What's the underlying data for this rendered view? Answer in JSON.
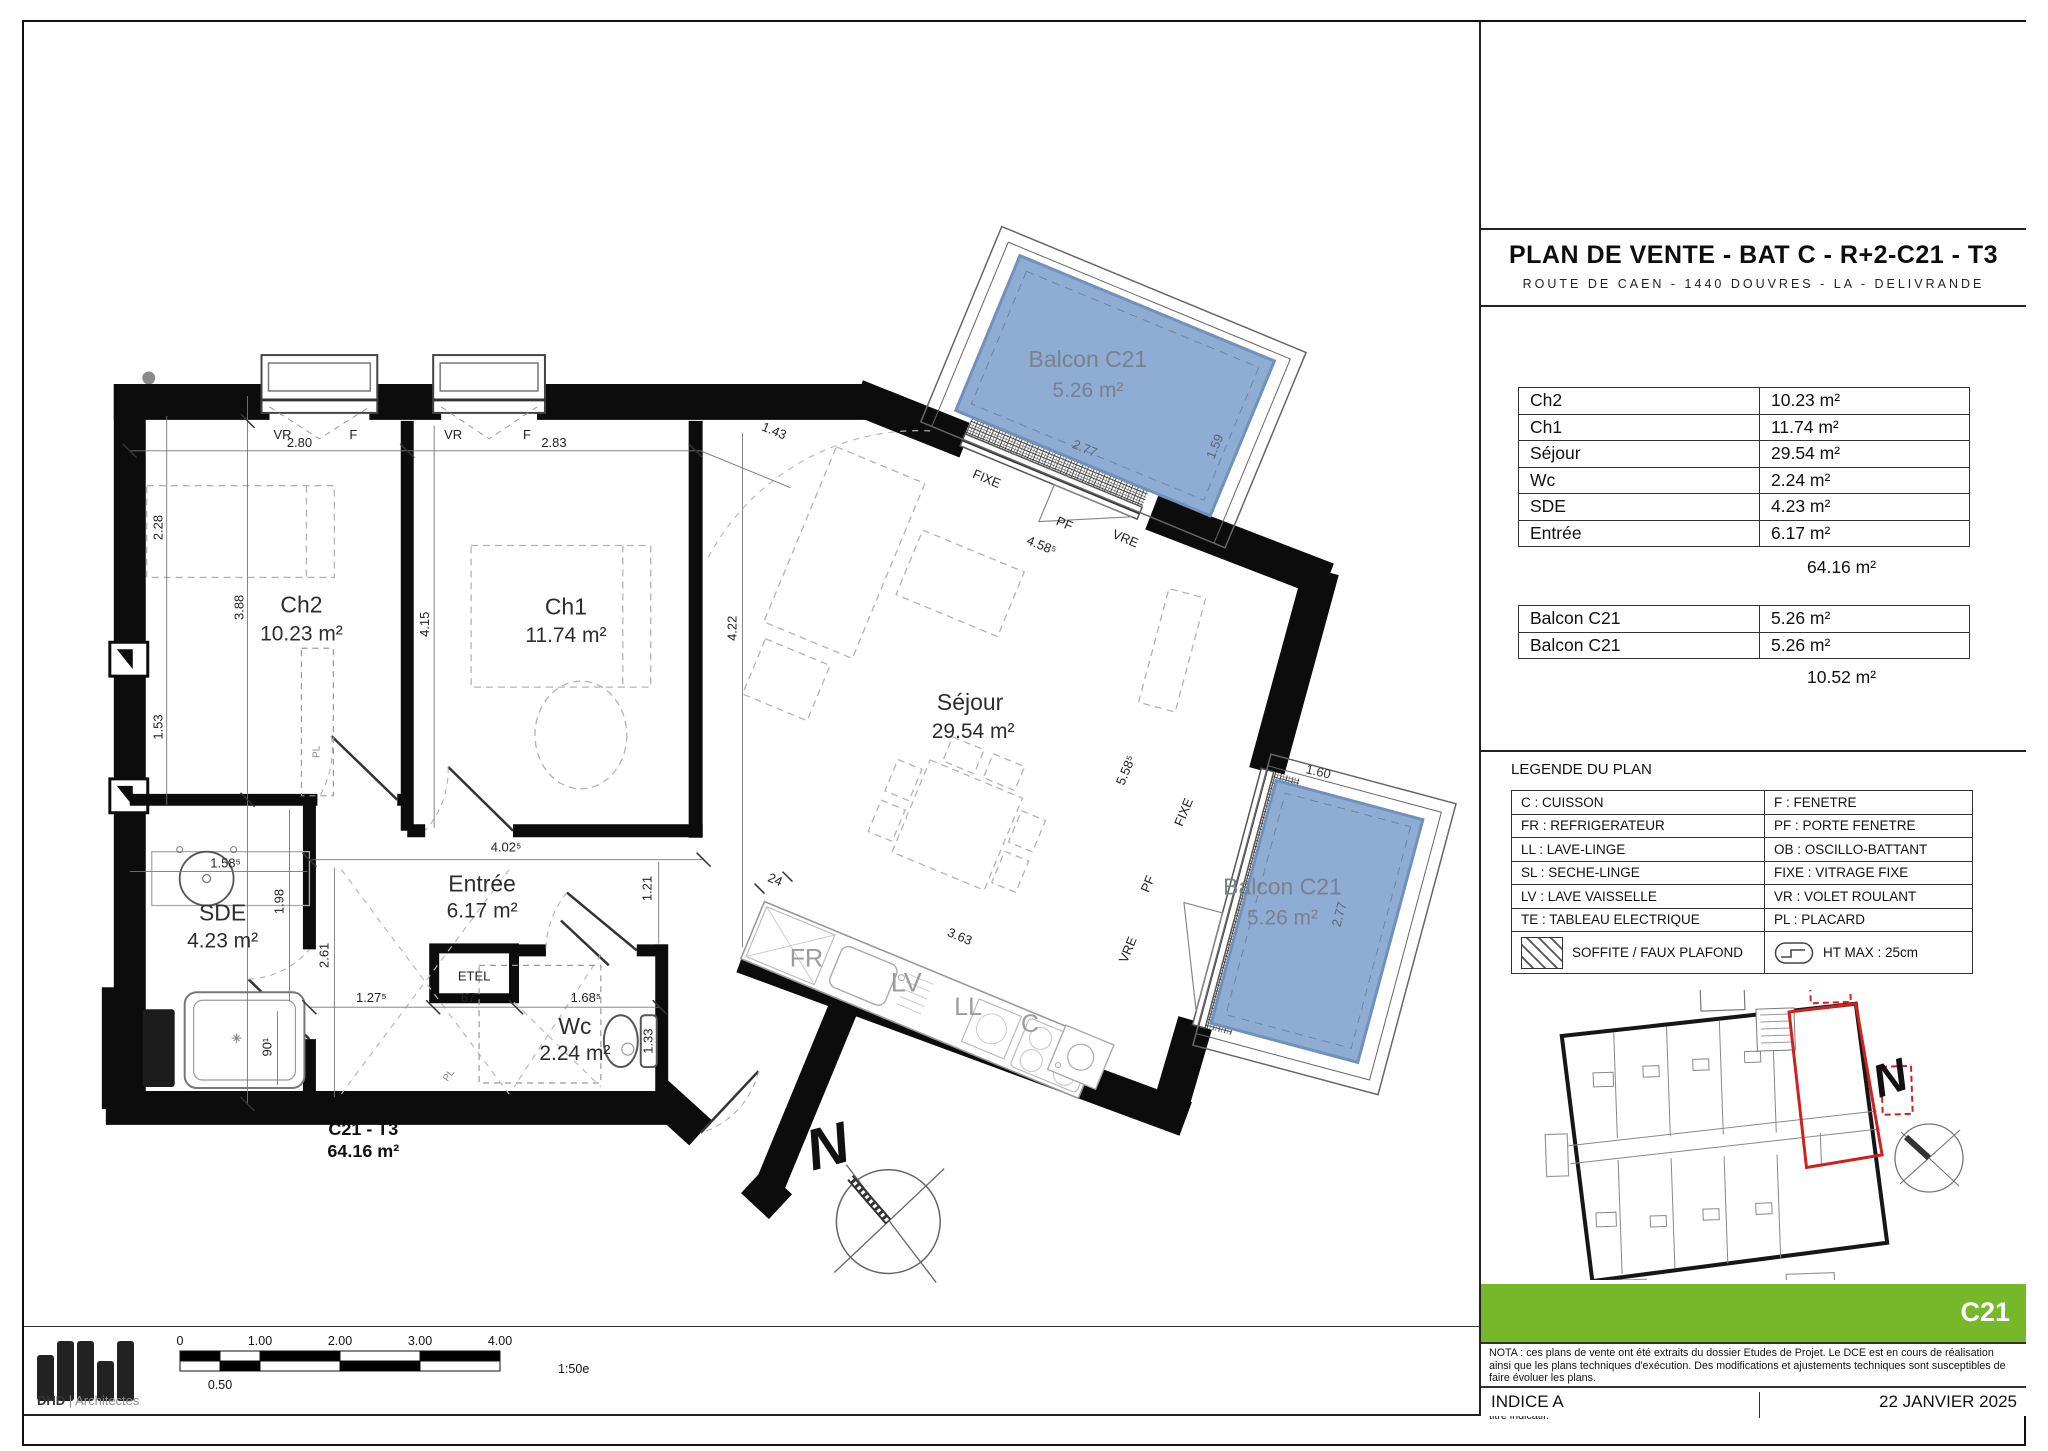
{
  "title": {
    "main": "PLAN DE VENTE - BAT C - R+2-C21 - T3",
    "address": "ROUTE DE CAEN - 1440 DOUVRES - LA - DELIVRANDE"
  },
  "areas": {
    "rows": [
      {
        "label": "Ch2",
        "value": "10.23 m²"
      },
      {
        "label": "Ch1",
        "value": "11.74 m²"
      },
      {
        "label": "Séjour",
        "value": "29.54 m²"
      },
      {
        "label": "Wc",
        "value": "2.24 m²"
      },
      {
        "label": "SDE",
        "value": "4.23 m²"
      },
      {
        "label": "Entrée",
        "value": "6.17 m²"
      }
    ],
    "total": "64.16 m²",
    "balcony_rows": [
      {
        "label": "Balcon C21",
        "value": "5.26 m²"
      },
      {
        "label": "Balcon C21",
        "value": "5.26 m²"
      }
    ],
    "balcony_total": "10.52 m²"
  },
  "legend": {
    "heading": "LEGENDE DU PLAN",
    "rows": [
      {
        "left": "C : CUISSON",
        "right": "F : FENETRE"
      },
      {
        "left": "FR : REFRIGERATEUR",
        "right": "PF : PORTE FENETRE"
      },
      {
        "left": "LL : LAVE-LINGE",
        "right": "OB : OSCILLO-BATTANT"
      },
      {
        "left": "SL : SECHE-LINGE",
        "right": "FIXE : VITRAGE FIXE"
      },
      {
        "left": "LV : LAVE VAISSELLE",
        "right": "VR : VOLET ROULANT"
      },
      {
        "left": "TE : TABLEAU ELECTRIQUE",
        "right": "PL : PLACARD"
      }
    ],
    "soffite": "SOFFITE / FAUX PLAFOND",
    "htmax": "HT MAX : 25cm"
  },
  "unit": {
    "code": "C21",
    "name": "C21 - T3",
    "area": "64.16 m²"
  },
  "footer": {
    "nota1": "NOTA : ces plans de vente ont été extraits du dossier Etudes de Projet. Le DCE est en cours de réalisation ainsi que les plans techniques d'exécution. Des modifications et ajustements techniques sont susceptibles de faire évoluer les plans.",
    "nota2": "Les poutres, poteaux, soffites, canalisations et faux plafonds n'apparaissent pas systématiquement sur le présent plan. Les éléments de mobilier (meubles, appareils ménagers et plans de travail) ne sont placés qu'à titre indicatif.",
    "indice": "INDICE A",
    "date": "22 JANVIER 2025"
  },
  "logo": {
    "name": "DHD",
    "divider": "|",
    "type": "Architectes"
  },
  "scalebar": {
    "ticks": [
      "0",
      "1.00",
      "2.00",
      "3.00",
      "4.00"
    ],
    "half": "0.50",
    "ratio": "1:50e"
  },
  "colors": {
    "green": "#76b82a",
    "balcony_blue": "#8fadd3",
    "highlight_red": "#d02020"
  },
  "plan": {
    "rooms": [
      {
        "name": "Ch2",
        "area": "10.23 m²"
      },
      {
        "name": "Ch1",
        "area": "11.74 m²"
      },
      {
        "name": "Séjour",
        "area": "29.54 m²"
      },
      {
        "name": "SDE",
        "area": "4.23 m²"
      },
      {
        "name": "Entrée",
        "area": "6.17 m²"
      },
      {
        "name": "Wc",
        "area": "2.24 m²"
      }
    ],
    "balconies": [
      {
        "name": "Balcon C21",
        "area": "5.26 m²"
      },
      {
        "name": "Balcon C21",
        "area": "5.26 m²"
      }
    ],
    "dims": {
      "d280": "2.80",
      "d283": "2.83",
      "d143": "1.43",
      "d228": "2.28",
      "d388": "3.88",
      "d153": "1.53",
      "d415": "4.15",
      "d422": "4.22",
      "d1585": "1.58⁵",
      "d198": "1.98",
      "d261": "2.61",
      "d1275": "1.27⁵",
      "d67": "67",
      "d1685": "1.68⁵",
      "d133": "1.33",
      "d901": "90¹",
      "d121": "1.21",
      "d4025": "4.02⁵",
      "d24": "24",
      "d363": "3.63",
      "d4585": "4.58⁵",
      "d5585": "5.58⁵",
      "d277a": "2.77",
      "d159": "1.59",
      "d160": "1.60",
      "d277b": "2.77"
    },
    "labels": {
      "vr": "VR",
      "f": "F",
      "fixe": "FIXE",
      "pf": "PF",
      "vre": "VRE",
      "etel": "ETEL",
      "pl": "PL",
      "north": "N",
      "fr": "FR",
      "lv": "LV",
      "ll": "LL",
      "c": "C"
    }
  }
}
